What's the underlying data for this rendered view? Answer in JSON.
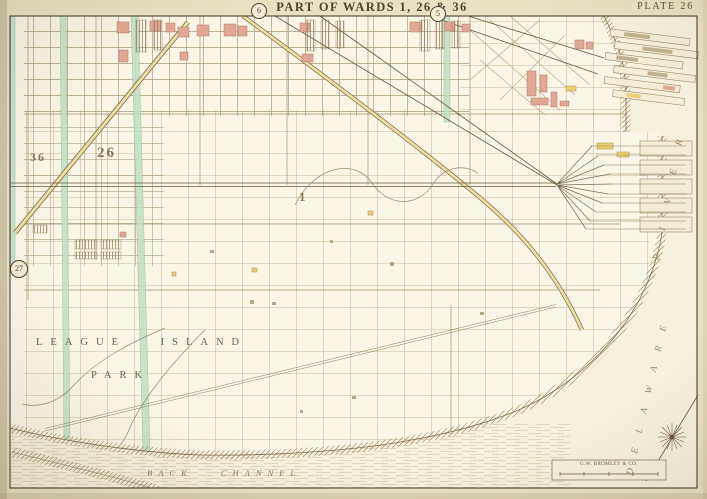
{
  "header": {
    "title": "PART OF WARDS 1, 26 & 36",
    "plate_label": "PLATE 26"
  },
  "adjoining_plate_markers": {
    "top_left": "6",
    "top_center": "5",
    "left": "27"
  },
  "ward_numbers": {
    "ward_36": "36",
    "ward_26": "26",
    "ward_1": "1"
  },
  "place_labels": {
    "league_island": "LEAGUE ISLAND",
    "park": "PARK",
    "back_channel": "BACK CHANNEL",
    "delaware": "DELAWARE",
    "river": "RIVER"
  },
  "publisher": {
    "imprint": "G.W. BROMLEY & CO."
  },
  "colors": {
    "paper": "#e9e1c4",
    "map_field": "#f6f1de",
    "land": "#faf6e7",
    "line_sepia": "#6b5b41",
    "street_green": "#c2e2c6",
    "road_yellow": "#ecdf9e",
    "building_pink": "#e3a894",
    "grid_faint": "#c7b897"
  }
}
